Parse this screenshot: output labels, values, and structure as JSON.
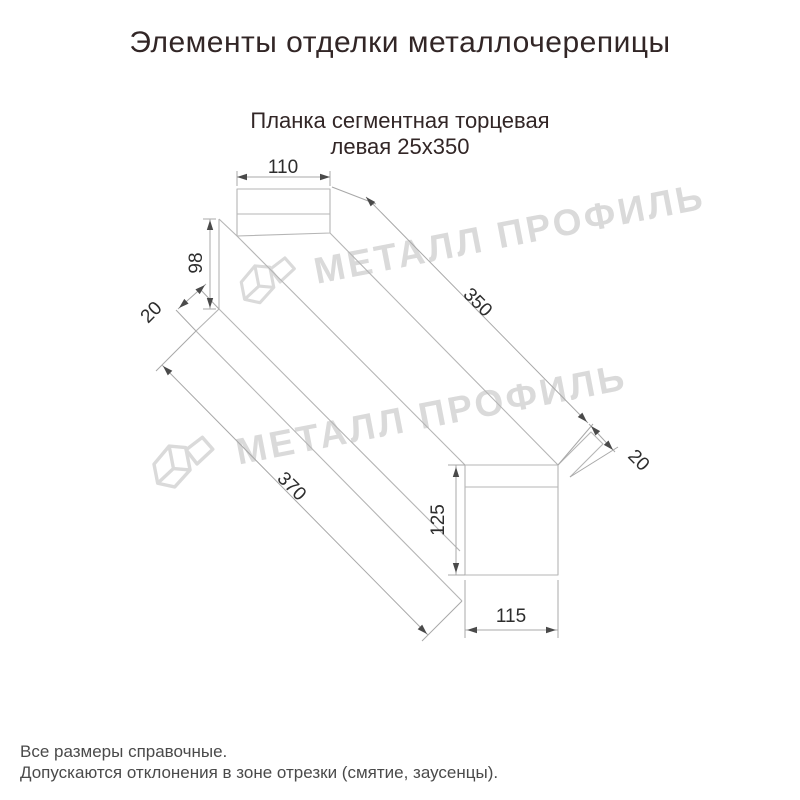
{
  "header": {
    "title": "Элементы отделки металлочерепицы"
  },
  "product": {
    "subtitle_line1": "Планка сегментная торцевая",
    "subtitle_line2": "левая 25x350"
  },
  "drawing": {
    "type": "isometric technical line drawing of metal segmented end trim strip",
    "dimensions": {
      "top_width": "110",
      "left_height": "98",
      "near_fold": "20",
      "top_length": "350",
      "far_fold": "20",
      "bottom_length": "370",
      "end_height": "125",
      "end_width": "115"
    }
  },
  "watermark": {
    "text": "МЕТАЛЛ ПРОФИЛЬ"
  },
  "footer": {
    "notes": [
      "Все размеры справочные.",
      "Допускаются отклонения в зоне отрезки (смятие, заусенцы)."
    ]
  },
  "colors": {
    "background": "#ffffff",
    "heading_text": "#322626",
    "dimension_text": "#2d2d2d",
    "drawing_line": "#b5b5b5",
    "arrow": "#4a4a4a",
    "watermark": "#dadada",
    "footnote_text": "#4a4a4a"
  }
}
